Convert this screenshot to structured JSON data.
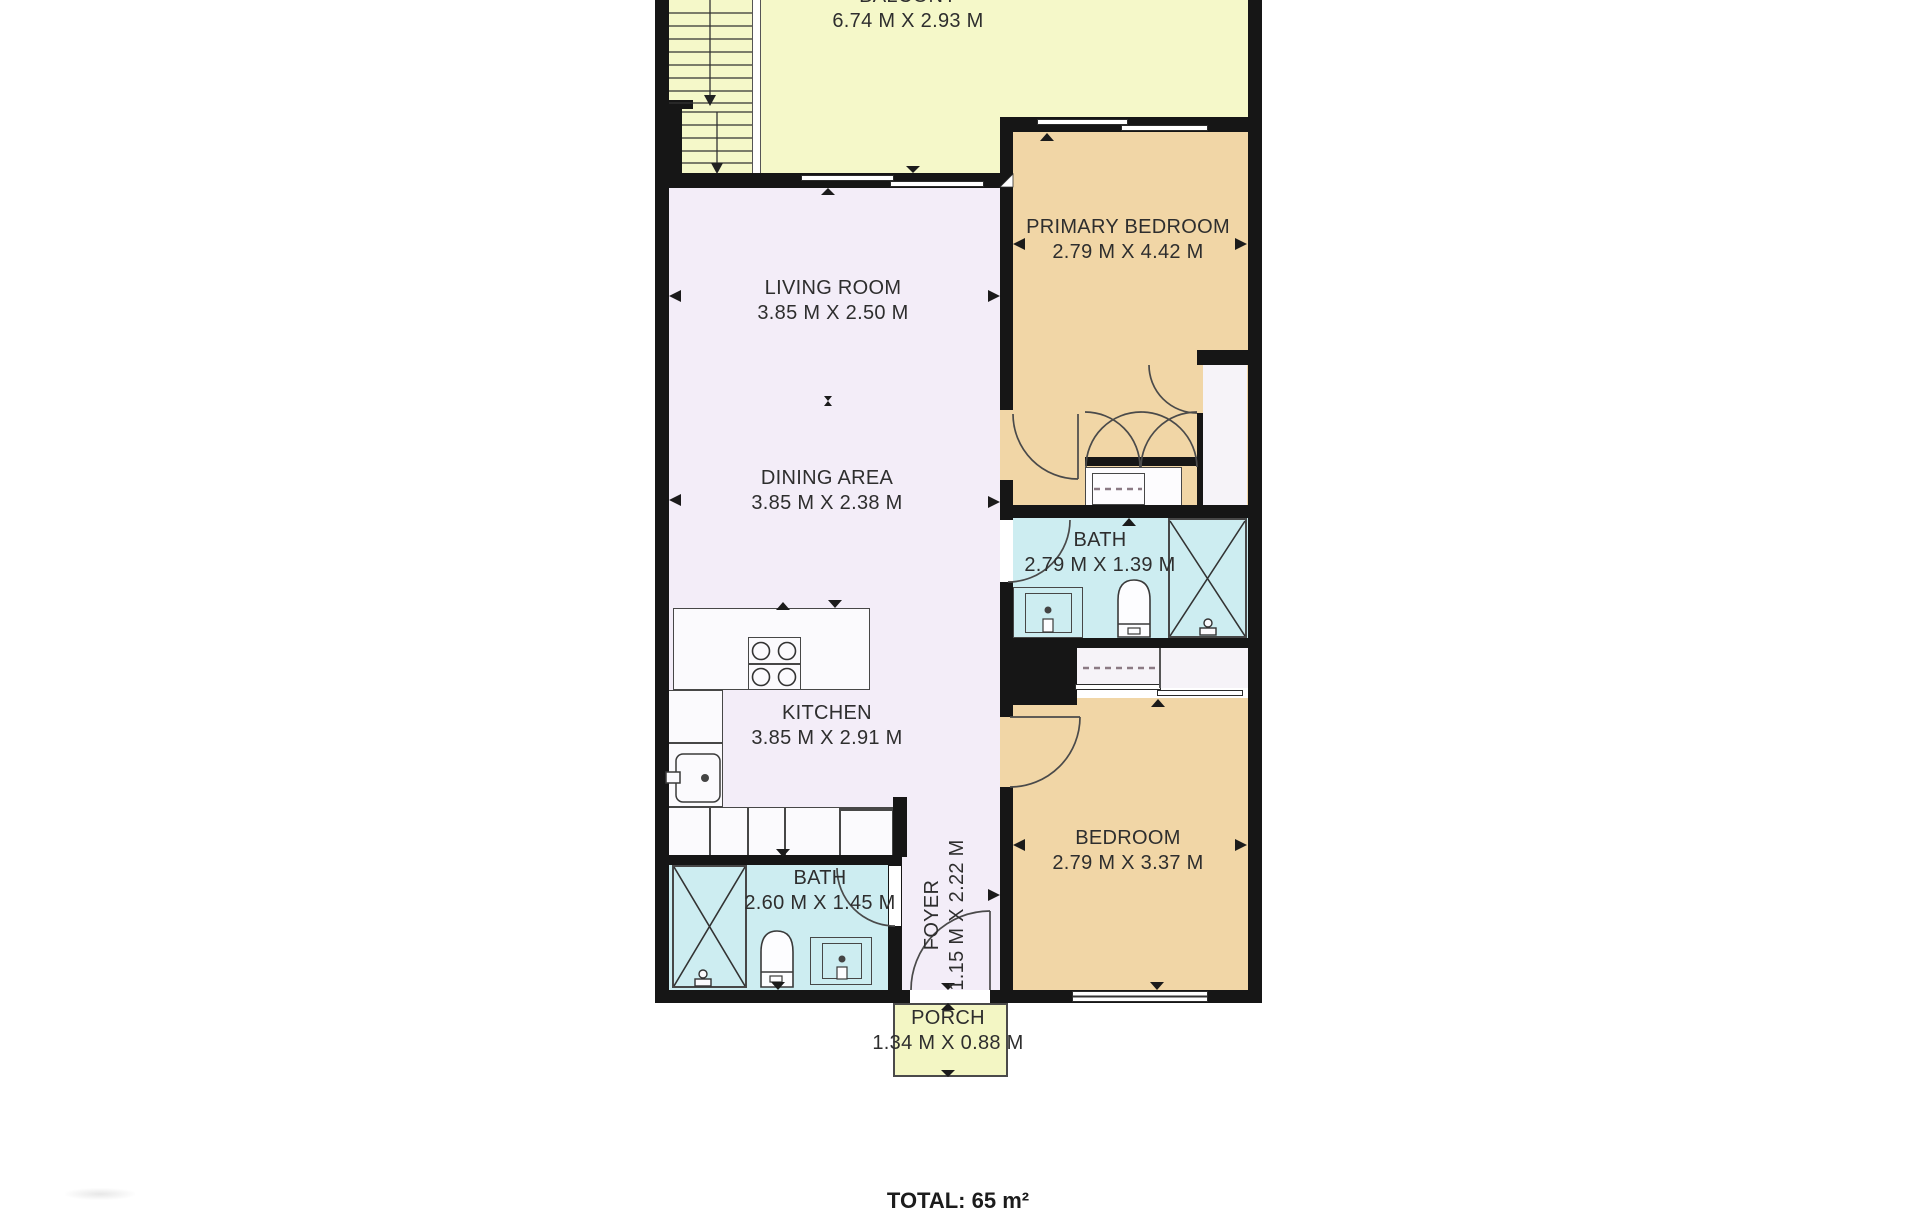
{
  "plan_title": "floor-plan",
  "rooms": {
    "balcony": {
      "name": "BALCONY",
      "dims": "6.74 M X 2.93 M"
    },
    "living_room": {
      "name": "LIVING ROOM",
      "dims": "3.85 M X 2.50 M"
    },
    "dining_area": {
      "name": "DINING AREA",
      "dims": "3.85 M X 2.38 M"
    },
    "kitchen": {
      "name": "KITCHEN",
      "dims": "3.85 M X 2.91 M"
    },
    "primary_bedroom": {
      "name": "PRIMARY BEDROOM",
      "dims": "2.79 M X 4.42 M"
    },
    "bath_primary": {
      "name": "BATH",
      "dims": "2.79 M X 1.39 M"
    },
    "bedroom": {
      "name": "BEDROOM",
      "dims": "2.79 M X 3.37 M"
    },
    "bath_main": {
      "name": "BATH",
      "dims": "2.60 M X 1.45 M"
    },
    "foyer": {
      "name": "FOYER",
      "dims": "1.15 M X 2.22 M"
    },
    "porch": {
      "name": "PORCH",
      "dims": "1.34 M X 0.88 M"
    }
  },
  "summary": {
    "total_label": "TOTAL: 65 m²"
  },
  "colors": {
    "wall": "#161616",
    "balcony": "#f5f8c9",
    "porch": "#f3f6c4",
    "living": "#f3edf8",
    "bedroom": "#f1d6a6",
    "bath": "#cdedf1",
    "closet": "#f6f3f8",
    "fixture_border": "#474747",
    "text": "#2e2e2e"
  }
}
